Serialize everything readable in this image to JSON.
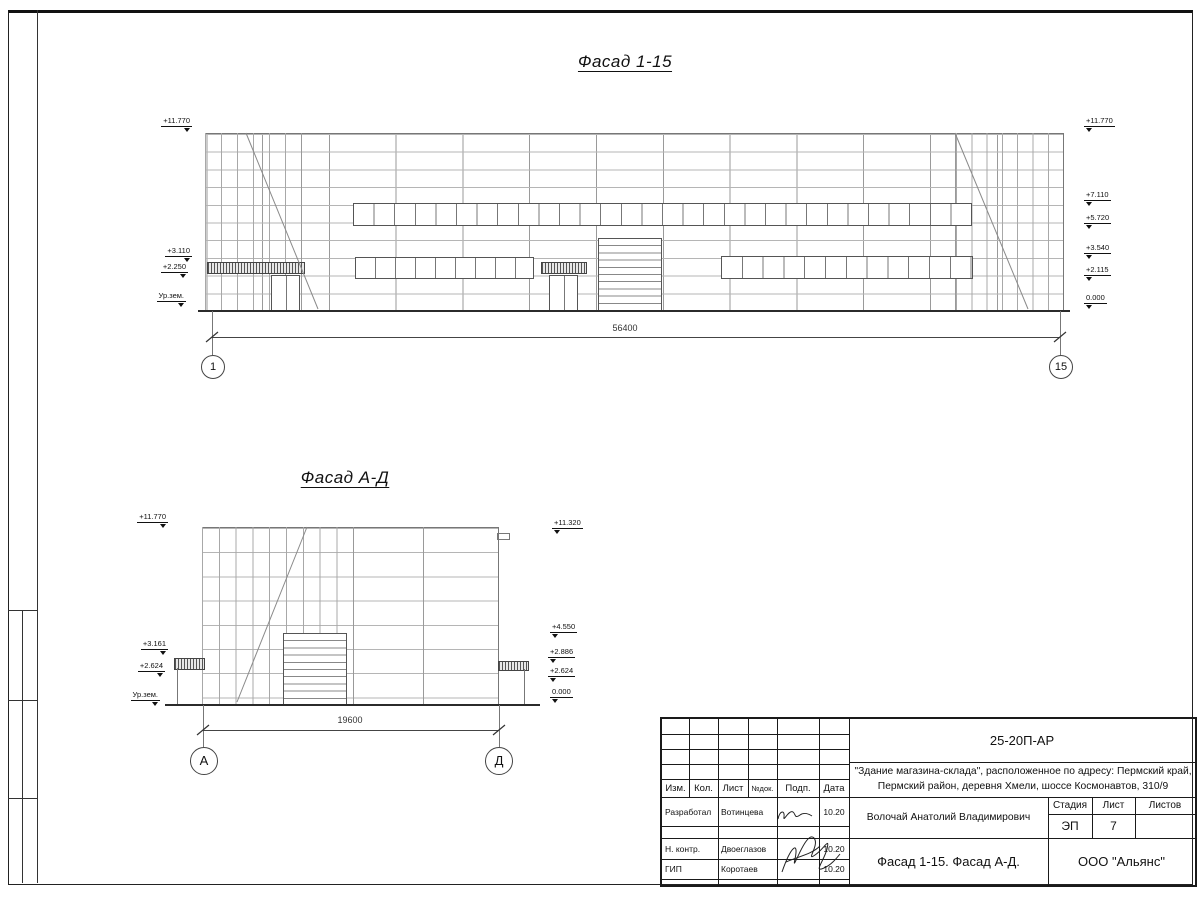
{
  "sheet": {
    "stamp_strip": {
      "labels": [
        "Взам. инв. №",
        "Подп. и дата",
        "Инв. № подл."
      ]
    }
  },
  "facade1": {
    "title": "Фасад 1-15",
    "marks_left": [
      "+11.770",
      "+3.110",
      "+2.250",
      "Ур.зем."
    ],
    "marks_right": [
      "+11.770",
      "+7.110",
      "+5.720",
      "+3.540",
      "+2.115",
      "0.000"
    ],
    "dimension": "56400",
    "axis_start": "1",
    "axis_end": "15"
  },
  "facade2": {
    "title": "Фасад А-Д",
    "marks_left": [
      "+11.770",
      "+3.161",
      "+2.624",
      "Ур.зем."
    ],
    "marks_right": [
      "+11.320",
      "+4.550",
      "+2.886",
      "+2.624",
      "0.000"
    ],
    "dimension": "19600",
    "axis_start": "А",
    "axis_end": "Д"
  },
  "titleblock": {
    "doc_number": "25-20П-АР",
    "project_line1": "\"Здание магазина-склада\", расположенное по адресу: Пермский край,",
    "project_line2": "Пермский район, деревня Хмели, шоссе Космонавтов, 310/9",
    "header": {
      "izm": "Изм.",
      "kol": "Кол.",
      "list": "Лист",
      "ndok": "№док.",
      "podp": "Подп.",
      "data": "Дата"
    },
    "rows": [
      {
        "role": "Разработал",
        "name": "Вотинцева",
        "date": "10.20"
      },
      {
        "role": "Н. контр.",
        "name": "Двоеглазов",
        "date": "10.20"
      },
      {
        "role": "ГИП",
        "name": "Коротаев",
        "date": "10.20"
      }
    ],
    "architect": "Волочай Анатолий Владимирович",
    "sheet_title": "Фасад 1-15. Фасад А-Д.",
    "stage_label": "Стадия",
    "sheet_label": "Лист",
    "sheets_label": "Листов",
    "stage": "ЭП",
    "sheet_no": "7",
    "sheets_total": "",
    "company": "ООО \"Альянс\""
  }
}
